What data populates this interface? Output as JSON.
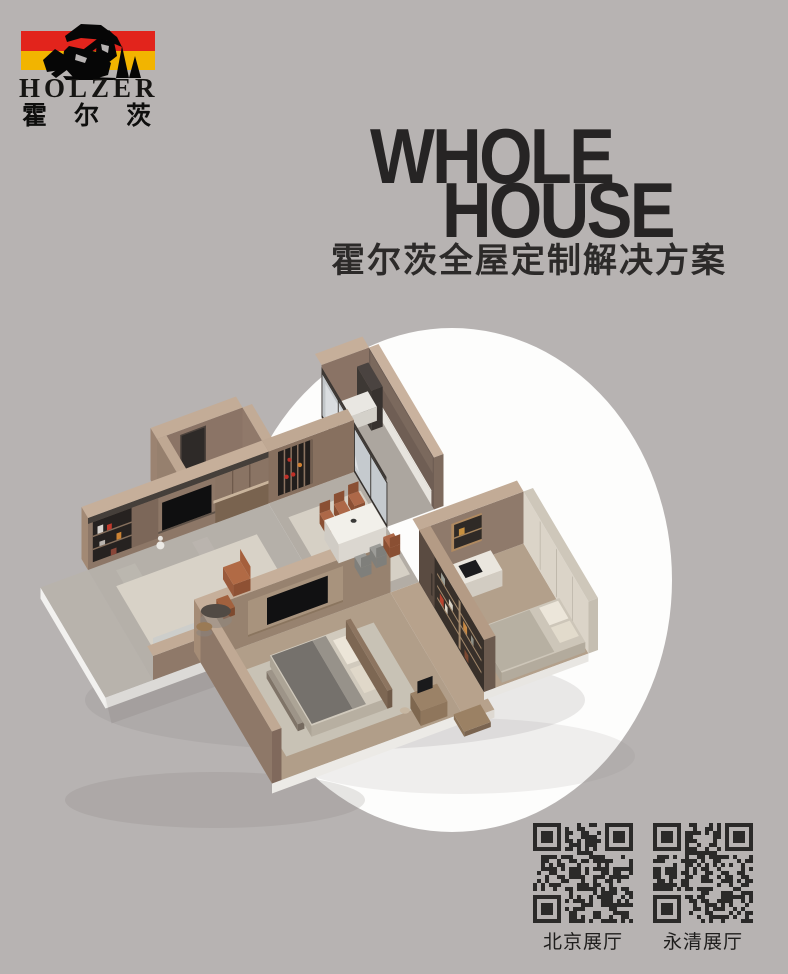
{
  "page": {
    "background_color": "#b7b3b2"
  },
  "logo": {
    "name_en": "HOLZER",
    "name_cn": "霍尔茨",
    "stripe_red": "#e2241c",
    "stripe_yellow": "#f2b400",
    "emblem": "lumberjack-with-axe-and-fir-trees silhouette"
  },
  "title": {
    "line1": "WHOLE",
    "line2": "HOUSE",
    "subtitle": "霍尔茨全屋定制解决方案",
    "text_color": "#262424"
  },
  "illustration": {
    "description": "isometric cutaway 3D floor plan of a furnished apartment (living room, dining, kitchen with glass sliders, study bedroom, master bedroom, balcony) on a white circle",
    "circle_color": "#fdfdfc"
  },
  "qr": {
    "module_color": "#2b2a29",
    "items": [
      {
        "label": "北京展厅"
      },
      {
        "label": "永清展厅"
      }
    ]
  }
}
